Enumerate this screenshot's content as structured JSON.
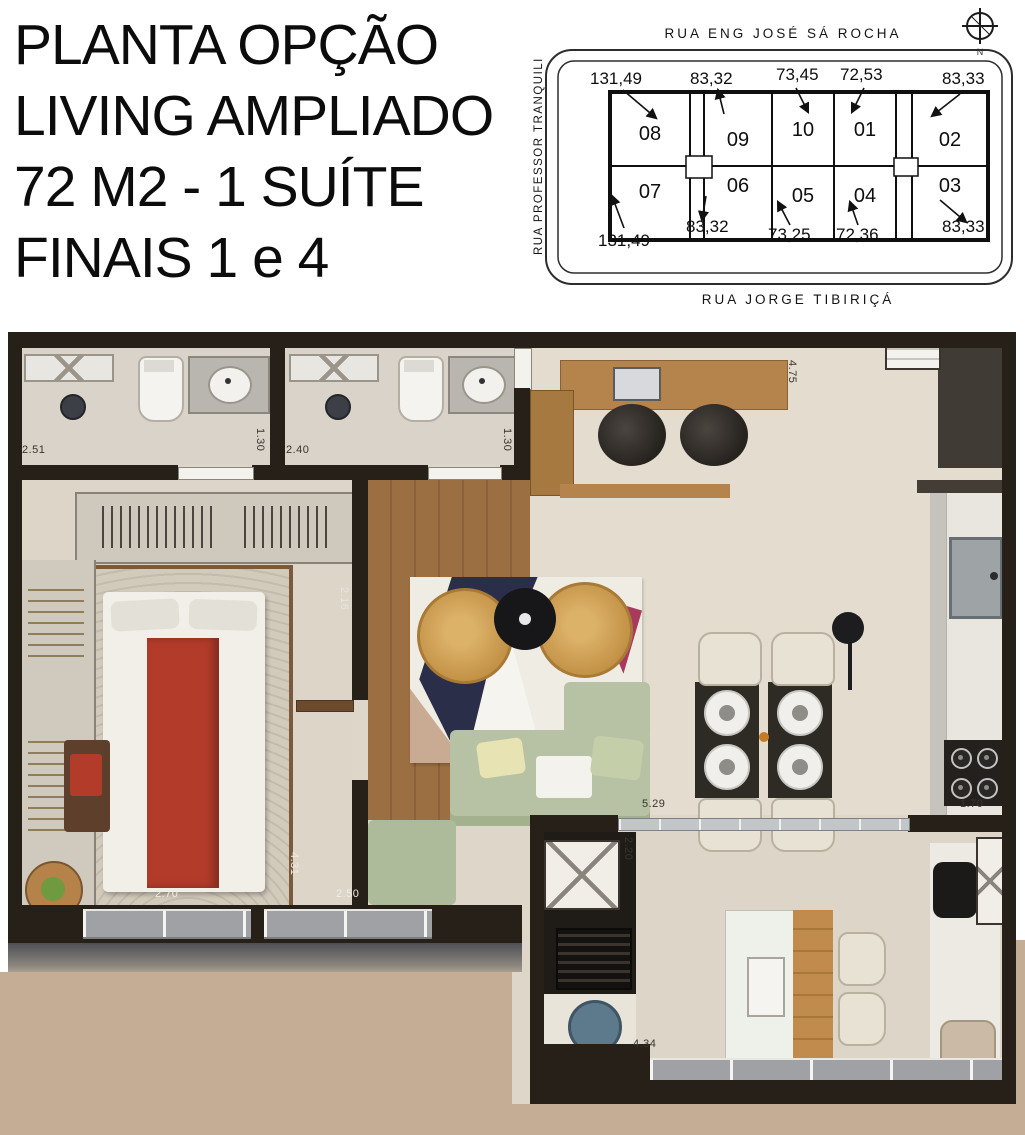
{
  "title": {
    "lines": [
      "PLANTA OPÇÃO",
      "LIVING AMPLIADO",
      "72 M2 - 1 SUÍTE",
      "FINAIS 1 e 4"
    ]
  },
  "site_plan": {
    "streets": {
      "top": "RUA ENG JOSÉ SÁ ROCHA",
      "left": "RUA PROFESSOR TRANQUILI",
      "bottom": "RUA JORGE TIBIRIÇÁ"
    },
    "compass_label": "N",
    "units_top": [
      {
        "number": "08",
        "area": "131,49"
      },
      {
        "number": "09",
        "area": "83,32"
      },
      {
        "number": "10",
        "area": "73,45"
      },
      {
        "number": "01",
        "area": "72,53"
      },
      {
        "number": "02",
        "area": "83,33"
      }
    ],
    "units_bottom": [
      {
        "number": "07",
        "area": "131,49"
      },
      {
        "number": "06",
        "area": "83,32"
      },
      {
        "number": "05",
        "area": "73,25"
      },
      {
        "number": "04",
        "area": "72,36"
      },
      {
        "number": "03",
        "area": "83,33"
      }
    ]
  },
  "floor_plan": {
    "dims": {
      "bath1_width": "2.51",
      "bath1_depth": "1.30",
      "bath2_width": "2.40",
      "bath2_depth": "1.30",
      "hall_width": "2.16",
      "living_depth": "4.75",
      "bed_width": "2.70",
      "bed_depth": "4.31",
      "bed_window": "2.50",
      "living_width": "5.29",
      "service_depth": "2.20",
      "kitchen_width": "1.70",
      "terrace_width": "4.34"
    }
  },
  "colors": {
    "wall": "#262019",
    "floor_beige": "#ded6c9",
    "wood_floor": "#9c6f42",
    "bed_red": "#b23b2a",
    "sofa_green": "#b6c2a3",
    "pouf_yellow": "#d0a153",
    "rug_navy": "#2a2e49",
    "rug_magenta": "#a83a5e",
    "background_tan": "#c4ad94"
  }
}
